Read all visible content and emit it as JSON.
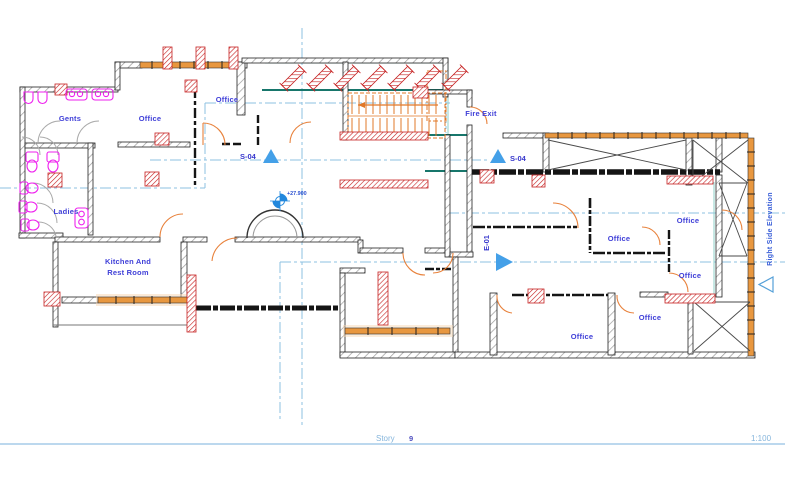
{
  "drawing_type": "floor-plan",
  "colors": {
    "wall_outline": "#222222",
    "wall_hatch": "#999999",
    "window_orange": "#e8973f",
    "fixture_magenta": "#ee22ee",
    "beam_red": "#c22020",
    "label_blue": "#4040d8",
    "marker_triangle_blue": "#44a0e8",
    "gridline_blue": "#8cc0e2",
    "teal_dark": "#17766b",
    "teal_light": "#8fd0c8",
    "stair_orange": "#e07828",
    "story_line_blue": "#a6cbe8"
  },
  "rooms": {
    "gents": "Gents",
    "ladies": "Ladies",
    "kitchen_line1": "Kitchen And",
    "kitchen_line2": "Rest Room",
    "office": "Office",
    "fire_exit": "Fire Exit"
  },
  "markers": {
    "section": "S-04",
    "elevation": "E-01",
    "level": "+27.900",
    "right_side_elevation": "Right Side Elevation"
  },
  "status_bar": {
    "story_label": "Story",
    "story_number": "9",
    "scale": "1:100"
  }
}
